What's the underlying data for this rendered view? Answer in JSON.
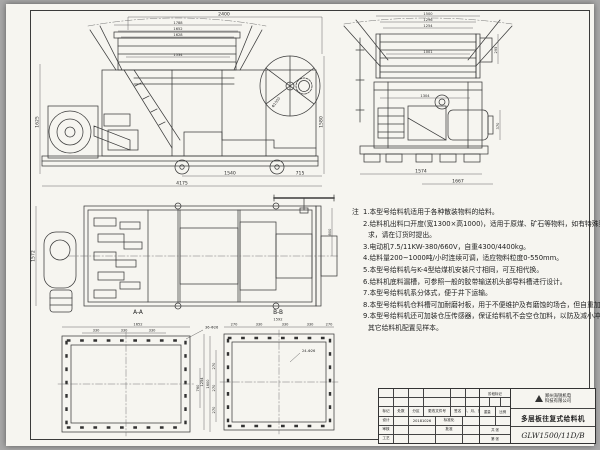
{
  "colors": {
    "paper": "#f6f5f0",
    "ink": "#3b3b3b",
    "background": "#a8a8a8"
  },
  "views": {
    "side": {
      "name": "主视图",
      "dims": {
        "top": "2400",
        "s1": "1788",
        "s2": "1652",
        "s3": "1628",
        "s4": "1534",
        "left": "1625",
        "right": "1580",
        "disc": "Φ1500",
        "b1": "1540",
        "b2": "715",
        "total": "4175"
      }
    },
    "end": {
      "name": "侧视图",
      "dims": {
        "t1": "1500",
        "t2": "1296",
        "t3": "1254",
        "inner": "1001",
        "flange": "295",
        "mid": "1304",
        "motor": "370",
        "b1": "1574",
        "b2": "1667"
      }
    },
    "plan": {
      "name": "俯视图",
      "dims": {
        "left": "1572",
        "right": "800"
      }
    },
    "section_a": {
      "label": "A-A",
      "width": "1652",
      "seg": "330",
      "holes": "36-Φ26",
      "inner_h": "760",
      "outer_h": "1600"
    },
    "section_b": {
      "label": "B-B",
      "width": "1592",
      "seg_end": "270",
      "seg_mid": "330",
      "holes": "24-Φ26",
      "left_seg": "270",
      "left_total": "1254"
    }
  },
  "notes": {
    "label": "注",
    "lines": [
      "1.本型号给料机适用于各种散装物料的给料。",
      "2.给料机出料口开度(宽1300×高1000)，适用于原煤、矿石等物料，如有特殊要",
      "求，请在订货时提出。",
      "3.电动机7.5/11KW-380/660V，自重4300/4400kg。",
      "4.给料量200~1000吨/小时连续可调，适应物料粒度0-550mm。",
      "5.本型号给料机与K-4型给煤机安装尺寸相同，可互相代换。",
      "6.给料机底料漏槽，可参照一般的胶带输送机头部导料槽进行设计。",
      "7.本型号给料机系分体式，便于井下运输。",
      "8.本型号给料机仓料槽可加耐磨衬板，用于不便维护及有磨蚀的场合，但自重加大。",
      "9.本型号给料机还可加装仓压传感器，保证给料机不会空仓加料，以防及减小冲击。",
      "其它给料机配置见样本。"
    ]
  },
  "titleblock": {
    "rev_headers": [
      "标记",
      "处数",
      "分区",
      "更改文件号",
      "签名",
      "年、月、日"
    ],
    "design_label": "设计",
    "check_label": "审核",
    "process_label": "工艺",
    "standard_label": "标准化",
    "approve_label": "批准",
    "design_date": "20181026",
    "stage_label": "阶段标记",
    "weight_label": "重量",
    "scale_label": "比例",
    "sheets_label": "共 张",
    "sheet_label": "第 张",
    "company_line1": "郑州海锐机电",
    "company_line2": "科技有限公司",
    "product": "多层板往复式给料机",
    "drawing_no": "GLW1500/11D/B"
  }
}
